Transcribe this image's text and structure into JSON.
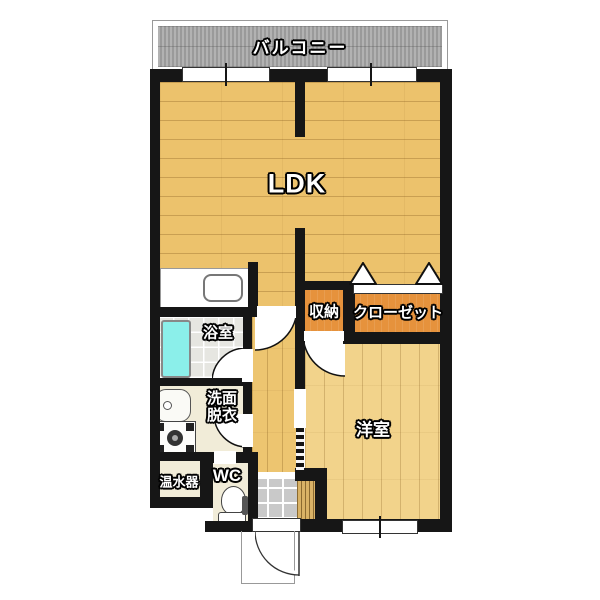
{
  "plan": {
    "type": "apartment-floor-plan",
    "rooms": {
      "balcony": {
        "label": "バルコニー"
      },
      "ldk": {
        "label": "LDK"
      },
      "storage": {
        "label": "収納"
      },
      "closet": {
        "label": "クローゼット"
      },
      "bathroom": {
        "label": "浴室"
      },
      "washroom": {
        "line1": "洗面",
        "line2": "脱衣"
      },
      "water_heater": {
        "label": "温水器"
      },
      "wc": {
        "label": "WC"
      },
      "western_room": {
        "label": "洋室"
      }
    },
    "fixtures": [
      "kitchen-sink",
      "bathtub",
      "washbasin",
      "washing-machine",
      "toilet",
      "entrance-step"
    ],
    "colors": {
      "wall": "#161616",
      "ldk_floor": "#ECC26C",
      "western_room_floor": "#F2D38B",
      "closet_orange": "#E6923C",
      "bathtub_cyan": "#8BEFEA",
      "balcony_gray": "#A6A6A6",
      "entrance_tile_gray": "#C9C9C9",
      "service_room_cream": "#F1ECD8"
    }
  }
}
